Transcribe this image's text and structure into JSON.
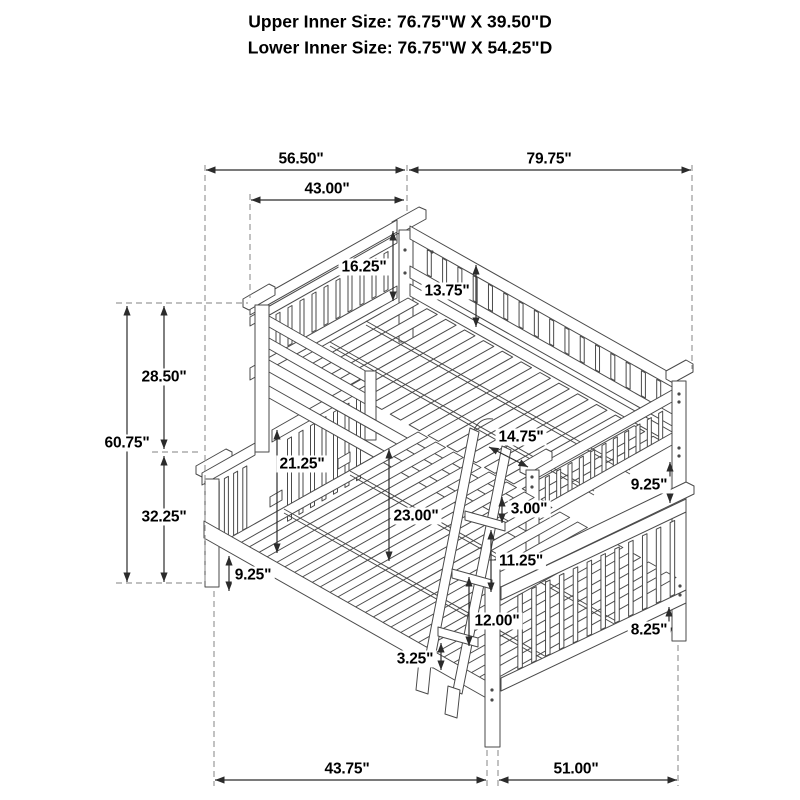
{
  "header": {
    "line1": "Upper Inner Size: 76.75\"W X 39.50\"D",
    "line2": "Lower Inner Size: 76.75\"W X 54.25\"D"
  },
  "dims": {
    "span_top_left": "56.50\"",
    "span_top_right": "79.75\"",
    "upper_headboard_width": "43.00\"",
    "upper_guard_height": "16.25\"",
    "upper_back_rail_height": "13.75\"",
    "upper_section_height": "28.50\"",
    "overall_height": "60.75\"",
    "lower_section_height": "32.25\"",
    "bunk_clearance": "21.25\"",
    "underbed_clearance": "23.00\"",
    "upper_depth_offset": "14.75\"",
    "rail_gap": "3.00\"",
    "right_rail_to_cap": "9.25\"",
    "ladder_rung_spacing": "11.25\"",
    "footboard_panel_height": "12.00\"",
    "ladder_foot_clearance": "3.25\"",
    "left_rail_to_floor": "9.25\"",
    "right_leg_height": "8.25\"",
    "span_bottom_left": "43.75\"",
    "span_bottom_right": "51.00\""
  },
  "colors": {
    "line": "#4a4a4a",
    "dimension": "#2b2b2b",
    "dashed": "#9a9a9a",
    "text": "#000000",
    "background": "#ffffff"
  }
}
